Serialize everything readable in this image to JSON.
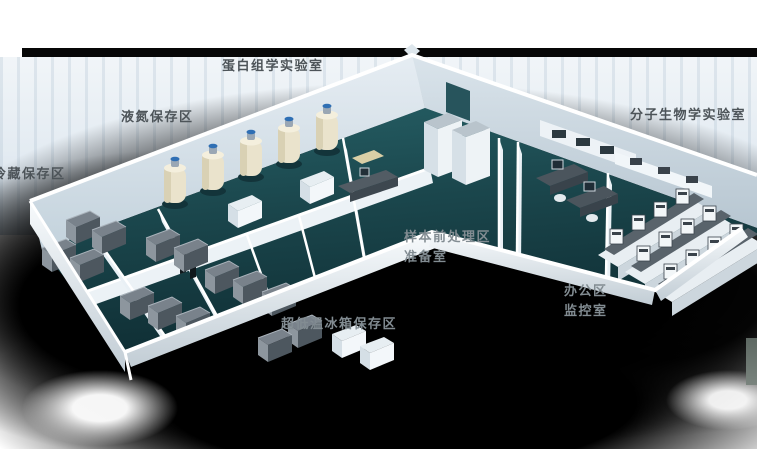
{
  "canvas": {
    "width": 757,
    "height": 449
  },
  "scene": {
    "kind": "3d-isometric-laboratory-floorplan",
    "wings": 2,
    "rooms_depicted": [
      "冷藏保存区",
      "液氮保存区",
      "超低温冰箱保存区",
      "蛋白组学实验室",
      "样本前处理区",
      "准备室",
      "办公区",
      "监控室",
      "分子生物学实验室"
    ]
  },
  "palette": {
    "floor_teal": "#1d4a50",
    "wall_light": "#e8eff4",
    "wall_rim_white": "#ffffff",
    "freezer_gray": "#4d575f",
    "tank_cream": "#eae3cc",
    "tank_cap_blue": "#2f6fb4",
    "backdrop_black": "#000000",
    "backdrop_stripe_blue": "#e3ebf2",
    "label_dark": "#4d5459",
    "label_light": "#828c92"
  },
  "area_labels": [
    {
      "id": "proteomics-lab",
      "text": "蛋白组学实验室",
      "x": 222,
      "y": 60,
      "tone": "dark"
    },
    {
      "id": "liquid-nitrogen-zone",
      "text": "液氮保存区",
      "x": 121,
      "y": 111,
      "tone": "dark"
    },
    {
      "id": "cold-storage-zone",
      "text": "冷藏保存区",
      "x": -7,
      "y": 168,
      "tone": "dark"
    },
    {
      "id": "molecular-biology-lab",
      "text": "分子生物学实验室",
      "x": 630,
      "y": 109,
      "tone": "dark"
    },
    {
      "id": "sample-pretreat-zone",
      "text": "样本前处理区",
      "x": 404,
      "y": 231,
      "tone": "light"
    },
    {
      "id": "prep-room",
      "text": "准备室",
      "x": 404,
      "y": 251,
      "tone": "light"
    },
    {
      "id": "office-zone",
      "text": "办公区",
      "x": 564,
      "y": 285,
      "tone": "light"
    },
    {
      "id": "monitor-room",
      "text": "监控室",
      "x": 564,
      "y": 305,
      "tone": "light"
    },
    {
      "id": "ult-freezer-zone",
      "text": "超低温冰箱保存区",
      "x": 281,
      "y": 318,
      "tone": "light"
    }
  ]
}
